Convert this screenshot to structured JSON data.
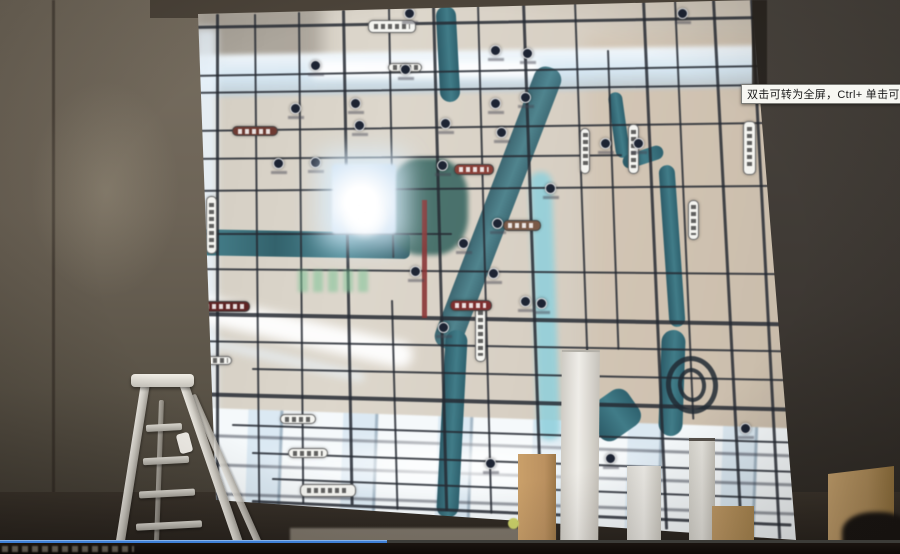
{
  "player": {
    "tooltip": "双击可转为全屏，Ctrl+ 单击可转为",
    "progress_percent": 43,
    "progress_color": "#3e7fd6"
  },
  "scene": {
    "objects": [
      "backlit-map-wall",
      "stepladder",
      "foreground-boxes",
      "dark-silhouette"
    ],
    "colors": {
      "wall": "#6d6457",
      "map_base": "#d7d1c6",
      "map_glow": "#eaf4fc",
      "road": "#262a33",
      "water": "#3e7884",
      "accent_red": "#8a3535",
      "poi": "#1d2433"
    }
  },
  "map": {
    "roads_h": [
      {
        "y": 26,
        "x": 0,
        "w": 600,
        "t": 3,
        "a": -1
      },
      {
        "y": 75,
        "x": 0,
        "w": 600,
        "t": 2,
        "a": -1
      },
      {
        "y": 92,
        "x": 0,
        "w": 600,
        "t": 2,
        "a": -0.8
      },
      {
        "y": 130,
        "x": 0,
        "w": 600,
        "t": 2,
        "a": -0.8
      },
      {
        "y": 158,
        "x": 0,
        "w": 430,
        "t": 2,
        "a": -0.5
      },
      {
        "y": 190,
        "x": 0,
        "w": 600,
        "t": 2,
        "a": -0.5
      },
      {
        "y": 233,
        "x": 0,
        "w": 260,
        "t": 2,
        "a": 0
      },
      {
        "y": 268,
        "x": 0,
        "w": 600,
        "t": 2,
        "a": 0.5
      },
      {
        "y": 312,
        "x": 0,
        "w": 600,
        "t": 3.5,
        "a": 1
      },
      {
        "y": 340,
        "x": 0,
        "w": 600,
        "t": 2,
        "a": 1
      },
      {
        "y": 368,
        "x": 60,
        "w": 540,
        "t": 2,
        "a": 1.2
      },
      {
        "y": 392,
        "x": 0,
        "w": 600,
        "t": 3.5,
        "a": 1.5
      },
      {
        "y": 424,
        "x": 40,
        "w": 560,
        "t": 2,
        "a": 1.8
      },
      {
        "y": 452,
        "x": 60,
        "w": 540,
        "t": 2,
        "a": 2
      },
      {
        "y": 478,
        "x": 80,
        "w": 520,
        "t": 2,
        "a": 2.2
      },
      {
        "y": 500,
        "x": 60,
        "w": 540,
        "t": 3,
        "a": 2.5
      }
    ],
    "roads_v": [
      {
        "x": 24,
        "y": 14,
        "h": 490,
        "t": 3,
        "a": 0
      },
      {
        "x": 62,
        "y": 14,
        "h": 490,
        "t": 2,
        "a": -0.5
      },
      {
        "x": 106,
        "y": 12,
        "h": 492,
        "t": 2,
        "a": -0.5
      },
      {
        "x": 150,
        "y": 10,
        "h": 495,
        "t": 2.5,
        "a": -1
      },
      {
        "x": 196,
        "y": 8,
        "h": 250,
        "t": 2,
        "a": -1
      },
      {
        "x": 199,
        "y": 300,
        "h": 210,
        "t": 2,
        "a": -1.5
      },
      {
        "x": 240,
        "y": 6,
        "h": 505,
        "t": 2.5,
        "a": -1.5
      },
      {
        "x": 285,
        "y": 4,
        "h": 510,
        "t": 2,
        "a": -1.5
      },
      {
        "x": 330,
        "y": 2,
        "h": 515,
        "t": 2.5,
        "a": -2
      },
      {
        "x": 382,
        "y": 2,
        "h": 515,
        "t": 2,
        "a": -2
      },
      {
        "x": 415,
        "y": 50,
        "h": 300,
        "t": 2,
        "a": -2
      },
      {
        "x": 450,
        "y": 0,
        "h": 530,
        "t": 2.5,
        "a": -2.5
      },
      {
        "x": 482,
        "y": 0,
        "h": 420,
        "t": 2,
        "a": -2.5
      },
      {
        "x": 520,
        "y": 0,
        "h": 535,
        "t": 2.5,
        "a": -3
      },
      {
        "x": 558,
        "y": 0,
        "h": 540,
        "t": 2.5,
        "a": -3
      },
      {
        "x": 588,
        "y": 0,
        "h": 545,
        "t": 2,
        "a": -3
      }
    ],
    "pois": [
      [
        98,
        103
      ],
      [
        158,
        98
      ],
      [
        81,
        158
      ],
      [
        118,
        157
      ],
      [
        183,
        183
      ],
      [
        248,
        118
      ],
      [
        298,
        98
      ],
      [
        304,
        127
      ],
      [
        328,
        92
      ],
      [
        353,
        183
      ],
      [
        300,
        218
      ],
      [
        296,
        268
      ],
      [
        328,
        296
      ],
      [
        344,
        298
      ],
      [
        266,
        238
      ],
      [
        218,
        266
      ],
      [
        408,
        138
      ],
      [
        441,
        138
      ],
      [
        208,
        64
      ],
      [
        298,
        45
      ],
      [
        330,
        48
      ],
      [
        548,
        423
      ],
      [
        413,
        453
      ],
      [
        293,
        458
      ],
      [
        246,
        322
      ],
      [
        162,
        120
      ],
      [
        118,
        60
      ],
      [
        245,
        160
      ],
      [
        212,
        8
      ],
      [
        485,
        8
      ]
    ],
    "road_labels": [
      {
        "x": 176,
        "y": 20,
        "w": 48,
        "h": 13,
        "v": 0
      },
      {
        "x": 196,
        "y": 63,
        "w": 34,
        "h": 9,
        "v": 0
      },
      {
        "x": 14,
        "y": 196,
        "w": 11,
        "h": 58,
        "v": 1
      },
      {
        "x": 283,
        "y": 304,
        "w": 11,
        "h": 58,
        "v": 1
      },
      {
        "x": 551,
        "y": 121,
        "w": 13,
        "h": 54,
        "v": 1
      },
      {
        "x": 436,
        "y": 124,
        "w": 11,
        "h": 50,
        "v": 1
      },
      {
        "x": 388,
        "y": 128,
        "w": 10,
        "h": 46,
        "v": 1
      },
      {
        "x": 496,
        "y": 200,
        "w": 11,
        "h": 40,
        "v": 1
      },
      {
        "x": 108,
        "y": 484,
        "w": 56,
        "h": 13,
        "v": 0
      },
      {
        "x": 88,
        "y": 414,
        "w": 36,
        "h": 10,
        "v": 0
      },
      {
        "x": 96,
        "y": 448,
        "w": 40,
        "h": 10,
        "v": 0
      },
      {
        "x": 10,
        "y": 356,
        "w": 30,
        "h": 9,
        "v": 0
      },
      {
        "x": 311,
        "y": 220,
        "w": 38,
        "h": 11,
        "v": 0,
        "bg": "#7a5a48"
      },
      {
        "x": 262,
        "y": 164,
        "w": 40,
        "h": 11,
        "v": 0,
        "bg": "#8a4038"
      },
      {
        "x": 258,
        "y": 300,
        "w": 42,
        "h": 11,
        "v": 0,
        "bg": "#7e2f2f"
      },
      {
        "x": 6,
        "y": 301,
        "w": 52,
        "h": 11,
        "v": 0,
        "bg": "#5e2424"
      },
      {
        "x": 40,
        "y": 126,
        "w": 46,
        "h": 10,
        "v": 0,
        "bg": "#6e3a32"
      }
    ]
  }
}
